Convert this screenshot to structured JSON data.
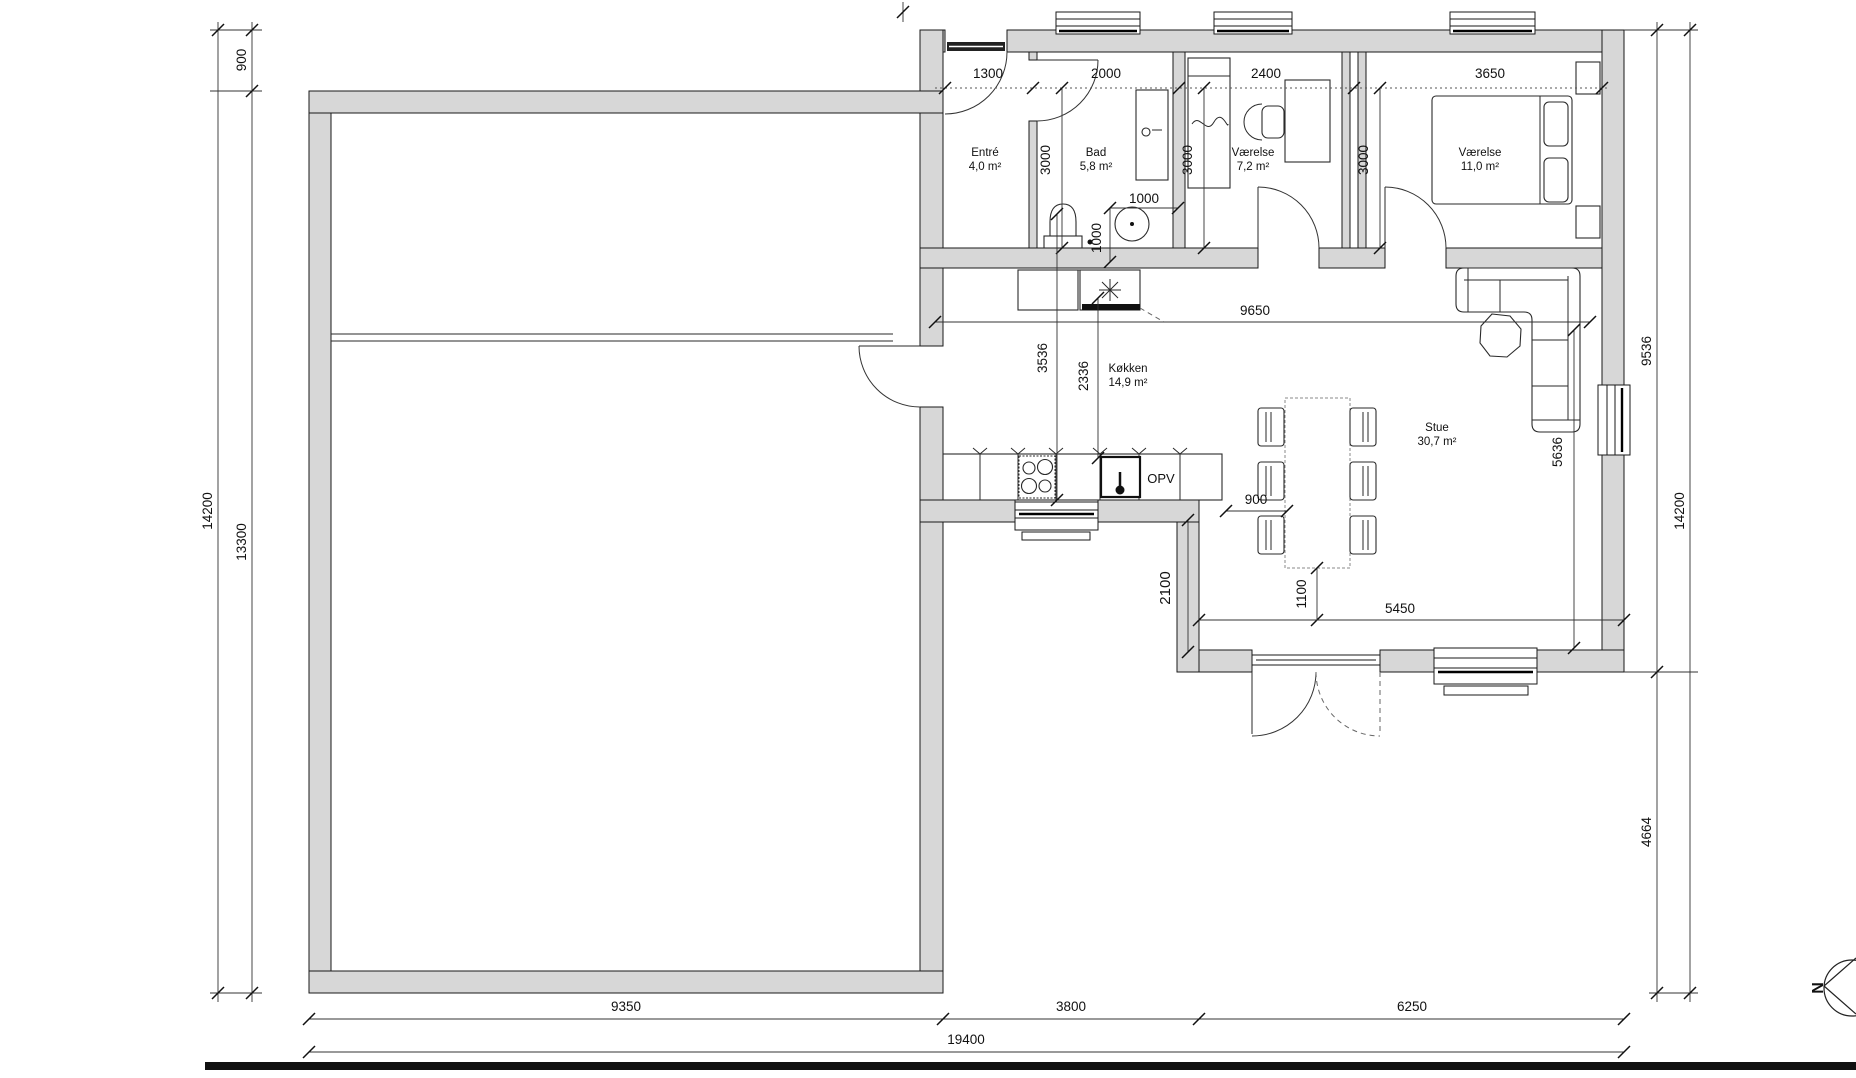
{
  "plan": {
    "rooms": {
      "entre": {
        "name": "Entré",
        "area": "4,0 m²"
      },
      "bad": {
        "name": "Bad",
        "area": "5,8 m²"
      },
      "vaerelse1": {
        "name": "Værelse",
        "area": "7,2 m²"
      },
      "vaerelse2": {
        "name": "Værelse",
        "area": "11,0 m²"
      },
      "koekken": {
        "name": "Køkken",
        "area": "14,9 m²"
      },
      "stue": {
        "name": "Stue",
        "area": "30,7 m²"
      }
    },
    "labels": {
      "d dishwasher_note": "",
      "dishwasher": "OPV",
      "north": "N"
    },
    "dims": {
      "top": {
        "entre": "1300",
        "bad": "2000",
        "vaerelse1": "2400",
        "vaerelse2": "3650"
      },
      "depth": {
        "bad": "3000",
        "vaerelse1": "3000",
        "vaerelse2": "3000"
      },
      "bath": {
        "width": "1000",
        "depth": "1000"
      },
      "interior": {
        "hall_width": "9650",
        "kitchen_a": "3536",
        "kitchen_b": "2336",
        "table_gap": "900",
        "step": "2100",
        "door_offset": "1100",
        "stue_width": "5450",
        "stue_depth": "5636"
      },
      "left": {
        "offset": "900",
        "garage": "13300",
        "total": "14200"
      },
      "right": {
        "upper": "9536",
        "lower": "4664",
        "total": "14200"
      },
      "bottom": {
        "garage": "9350",
        "mid": "3800",
        "stue": "6250",
        "total": "19400"
      }
    }
  }
}
